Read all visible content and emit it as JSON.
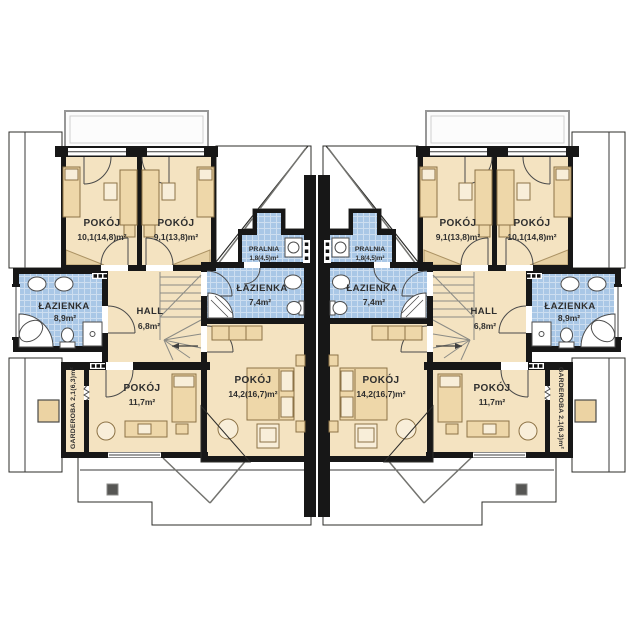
{
  "palette": {
    "roof_dark": "#4b4b49",
    "roof_line": "#3a3a38",
    "floor_beige": "#f4e3c1",
    "tile_blue": "#a9c7e6",
    "wall_black": "#171717",
    "furn_fill": "#eed7a9",
    "furn_line": "#8d7346",
    "text_color": "#2e2e2e"
  },
  "plan": {
    "kind": "duplex-upper-floor-plan",
    "units": [
      "left",
      "right"
    ],
    "rooms": {
      "pokoj_a": {
        "name": "POKÓJ",
        "area": "10,1(14,8)m²"
      },
      "pokoj_b": {
        "name": "POKÓJ",
        "area": "9,1(13,8)m²"
      },
      "pralnia": {
        "name": "PRALNIA",
        "area": "1,8(4,5)m²"
      },
      "lazienka_mala": {
        "name": "ŁAZIENKA",
        "area": "7,4m²"
      },
      "lazienka_duza": {
        "name": "ŁAZIENKA",
        "area": "8,9m²"
      },
      "hall": {
        "name": "HALL",
        "area": "6,8m²"
      },
      "pokoj_c": {
        "name": "POKÓJ",
        "area": "11,7m²"
      },
      "pokoj_d": {
        "name": "POKÓJ",
        "area": "14,2(16,7)m²"
      },
      "garderoba": {
        "name": "GARDEROBA",
        "area": "2,1(6,3)m²",
        "label": "GARDEROBA 2,1(6,3)m²"
      }
    }
  }
}
